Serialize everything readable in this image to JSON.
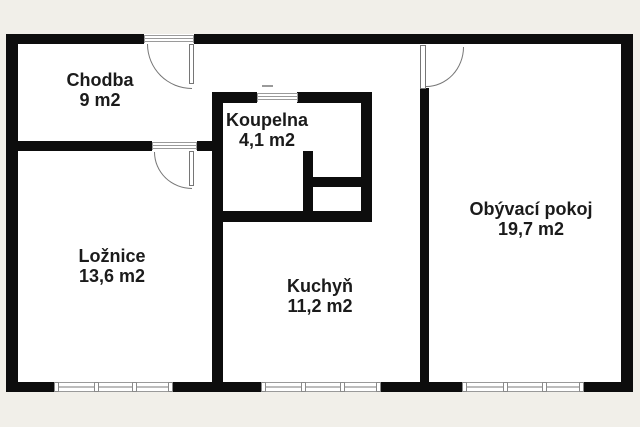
{
  "plan": {
    "type": "apartment-floor-plan",
    "rooms": [
      {
        "name": "Chodba",
        "area": "9 m2"
      },
      {
        "name": "Koupelna",
        "area": "4,1 m2"
      },
      {
        "name": "Ložnice",
        "area": "13,6 m2"
      },
      {
        "name": "Kuchyň",
        "area": "11,2 m2"
      },
      {
        "name": "Obývací pokoj",
        "area": "19,7 m2"
      }
    ],
    "colors": {
      "wall": "#0d0d0d",
      "background": "#f1efe9",
      "floor": "#ffffff",
      "fixture_line": "#9a9a9a",
      "label_text": "#1b1b1b"
    }
  }
}
